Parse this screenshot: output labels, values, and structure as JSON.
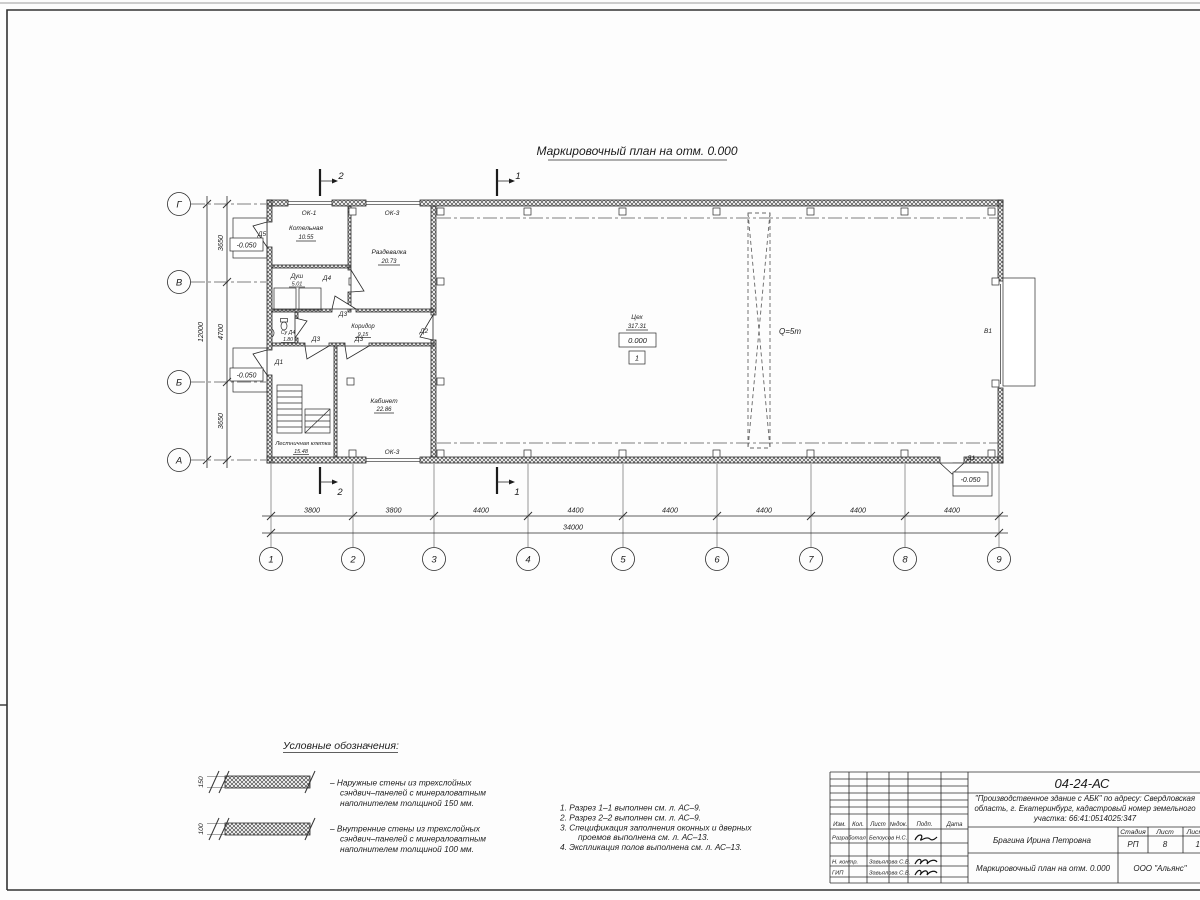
{
  "drawing": {
    "title": "Маркировочный план на отм. 0.000",
    "rooms": {
      "kotelnaya": {
        "name": "Котельная",
        "area": "10.55"
      },
      "razdevalka": {
        "name": "Раздевалка",
        "area": "20.73"
      },
      "dush": {
        "name": "Душ",
        "area": "5.01"
      },
      "su": {
        "name": "Су Д4",
        "area": "1.80"
      },
      "koridor": {
        "name": "Коридор",
        "area": "9.15"
      },
      "lestnitsa": {
        "name": "Лестничная клетка",
        "area": "15.48"
      },
      "kabinet": {
        "name": "Кабинет",
        "area": "22.86"
      },
      "tseh": {
        "name": "Цех",
        "area": "317.31"
      }
    },
    "doors": {
      "d1": "Д1",
      "d2": "Д2",
      "d3": "Д3",
      "d4": "Д4",
      "d5": "Д5"
    },
    "windows": {
      "ok1": "ОК-1",
      "ok3": "ОК-3"
    },
    "gate": "В1",
    "marks": {
      "crane": "Q=5т",
      "elev_zero": "0.000",
      "elev_minus": "-0.050",
      "floor_type": "1"
    },
    "sections": {
      "s1": "1",
      "s2": "2"
    },
    "axes": {
      "cols": [
        "1",
        "2",
        "3",
        "4",
        "5",
        "6",
        "7",
        "8",
        "9"
      ],
      "rows": [
        "Г",
        "В",
        "Б",
        "А"
      ]
    },
    "dims": {
      "col_dims": [
        "3800",
        "3800",
        "4400",
        "4400",
        "4400",
        "4400",
        "4400",
        "4400"
      ],
      "col_total": "34000",
      "row_dims": [
        "3650",
        "4700",
        "3650"
      ],
      "row_total": "12000"
    }
  },
  "legend": {
    "title": "Условные обозначения:",
    "items": [
      {
        "dim": "150",
        "lines": [
          "–  Наружные стены из трехслойных",
          "сэндвич–панелей с минераловатным",
          "наполнителем толщиной 150 мм."
        ]
      },
      {
        "dim": "100",
        "lines": [
          "–  Внутренние стены из трехслойных",
          "сэндвич–панелей с минераловатным",
          "наполнителем толщиной 100 мм."
        ]
      }
    ]
  },
  "notes": [
    "1. Разрез 1–1 выполнен см. л. АС–9.",
    "2. Разрез 2–2 выполнен см. л. АС–9.",
    "3. Спецификация заполнения оконных и дверных",
    "проемов выполнена см. л. АС–13.",
    "4. Экспликация полов выполнена см. л. АС–13."
  ],
  "title_block": {
    "code": "04-24-АС",
    "project_lines": [
      "\"Производственное здание с АБК\" по адресу: Свердловская",
      "область, г. Екатеринбург, кадастровый номер земельного",
      "участка: 66:41:0514025:347"
    ],
    "header_cols": [
      "Изм.",
      "Кол.",
      "Лист",
      "№док.",
      "Подп.",
      "Дата"
    ],
    "rows": [
      {
        "role": "Разработал",
        "name": "Белоусов Н.С."
      },
      {
        "role": "Н. контр.",
        "name": "Завьялова С.В."
      },
      {
        "role": "ГИП",
        "name": "Завьялова С.В."
      }
    ],
    "author": "Брагина Ирина Петровна",
    "stage_header": [
      "Стадия",
      "Лист",
      "Листов"
    ],
    "stage_values": [
      "РП",
      "8",
      "13"
    ],
    "sheet_title": "Маркировочный план на отм. 0.000",
    "company": "ООО \"Альянс\""
  }
}
